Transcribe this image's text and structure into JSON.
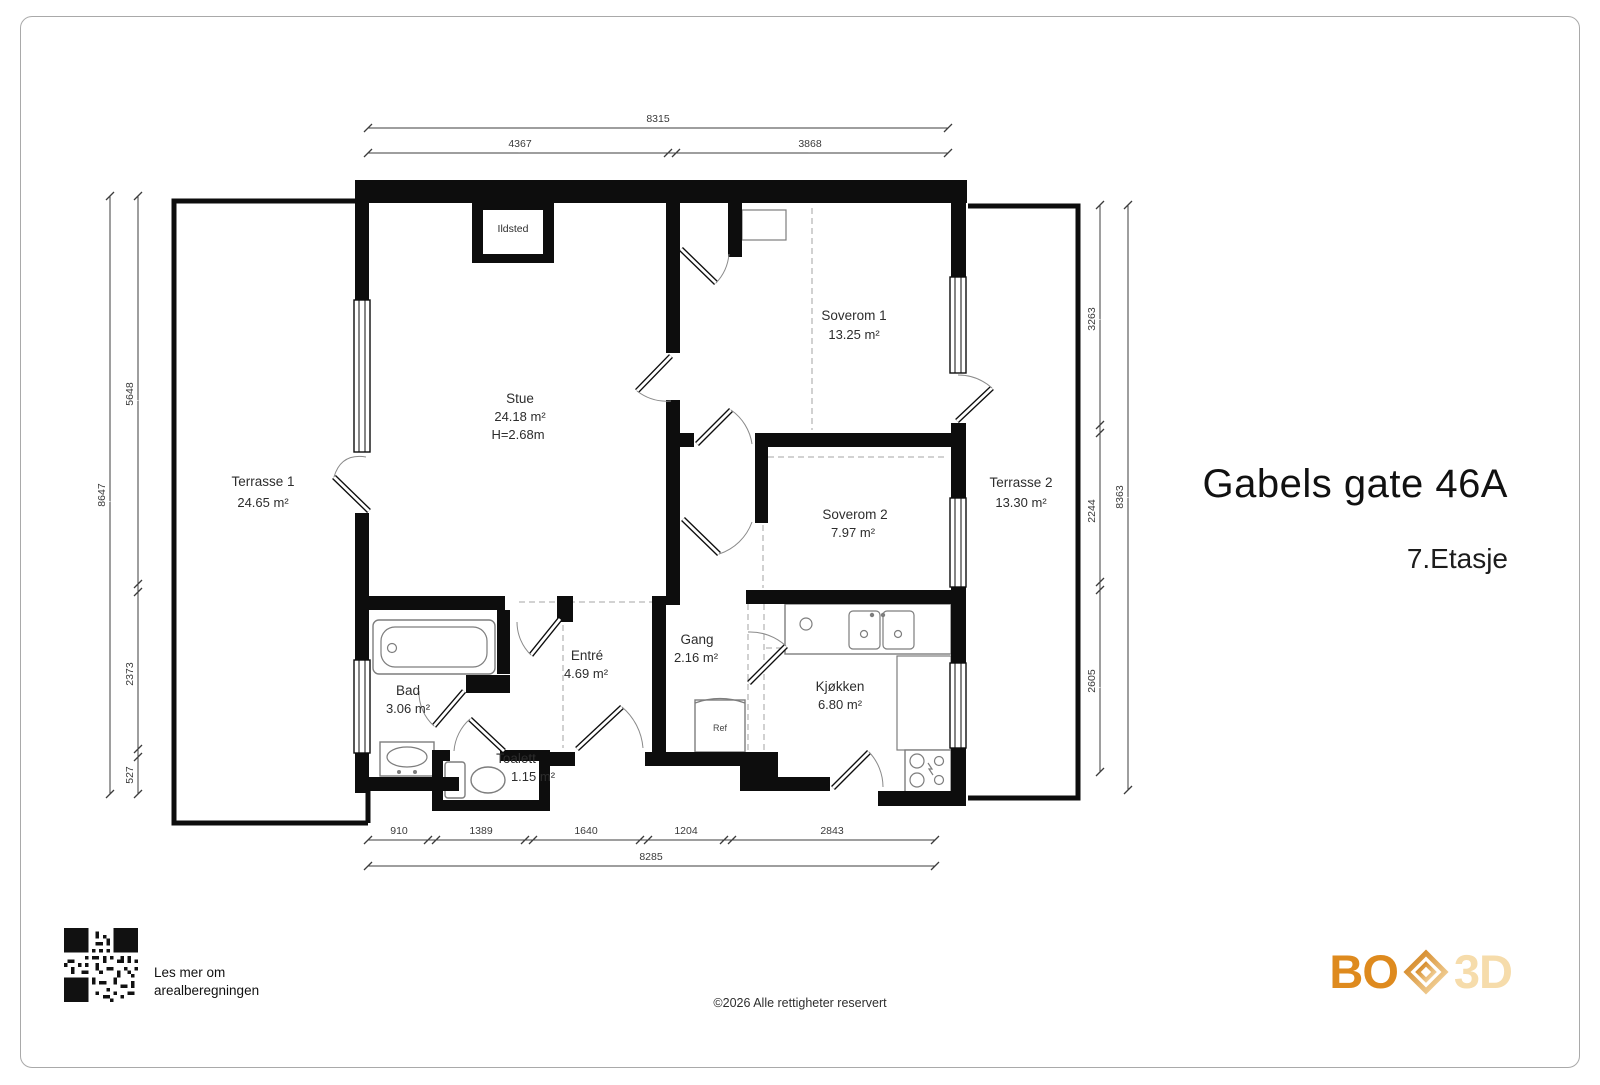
{
  "title": {
    "main": "Gabels gate 46A",
    "floor": "7.Etasje"
  },
  "rooms": [
    {
      "name": "Terrasse 1",
      "area": "24.65 m²"
    },
    {
      "name": "Stue",
      "area": "24.18 m²",
      "height": "H=2.68m"
    },
    {
      "name": "Soverom 1",
      "area": "13.25 m²"
    },
    {
      "name": "Soverom 2",
      "area": "7.97 m²"
    },
    {
      "name": "Terrasse 2",
      "area": "13.30 m²"
    },
    {
      "name": "Bad",
      "area": "3.06 m²"
    },
    {
      "name": "Toalett",
      "area": "1.15 m²"
    },
    {
      "name": "Entré",
      "area": "4.69 m²"
    },
    {
      "name": "Gang",
      "area": "2.16 m²"
    },
    {
      "name": "Kjøkken",
      "area": "6.80 m²"
    }
  ],
  "fixtures": {
    "fireplace": "Ildsted",
    "fridge": "Ref"
  },
  "dimensions": {
    "top": {
      "total": "8315",
      "segments": [
        "4367",
        "3868"
      ]
    },
    "bottom": {
      "total": "8285",
      "segments": [
        "910",
        "1389",
        "1640",
        "1204",
        "2843"
      ]
    },
    "left": {
      "total": "8647",
      "segments": [
        "5648",
        "2373",
        "527"
      ]
    },
    "right": {
      "total": "8363",
      "segments": [
        "3263",
        "2244",
        "2605"
      ]
    }
  },
  "footer": {
    "copyright": "©2026 Alle rettigheter reservert",
    "qr_caption_line1": "Les mer om",
    "qr_caption_line2": "arealberegningen"
  },
  "logo": {
    "bo": "BO",
    "threed": "3D",
    "color_dark": "#de8a1e",
    "color_light": "#f6dcab"
  }
}
